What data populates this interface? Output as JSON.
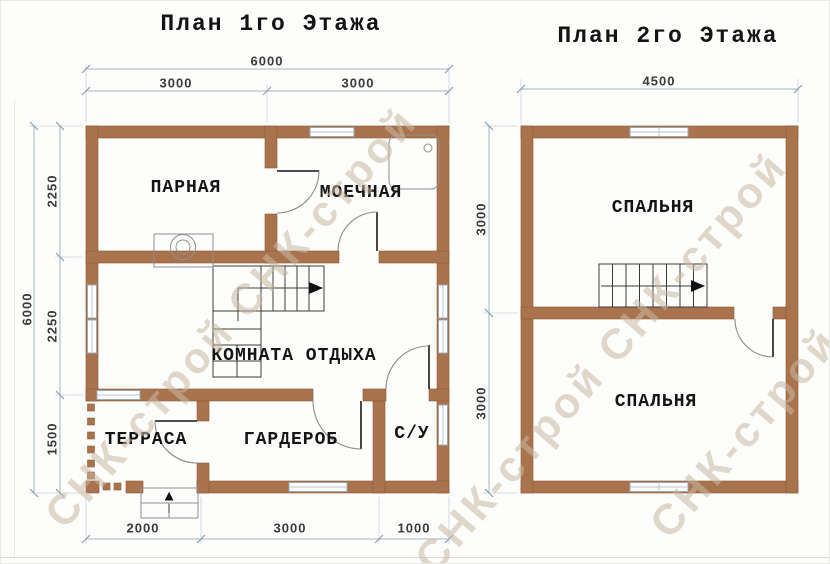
{
  "watermark": {
    "text": "СНК-строй",
    "stripes": [
      "СНК-строй СНК-строй",
      "СНК-строй СНК-строй",
      "СНК-строй"
    ],
    "color": "rgba(200,184,164,0.55)"
  },
  "floor1": {
    "title": "План 1го Этажа",
    "rooms": {
      "steam": "ПАРНАЯ",
      "wash": "МОЕЧНАЯ",
      "lounge": "КОМНАТА ОТДЫХА",
      "terrace": "ТЕРРАСА",
      "wardrobe": "ГАРДЕРОБ",
      "wc": "С/У"
    },
    "dims": {
      "top_total": "6000",
      "top_left": "3000",
      "top_right": "3000",
      "left_total": "6000",
      "left_top": "2250",
      "left_mid": "2250",
      "left_bottom": "1500",
      "bottom_left": "2000",
      "bottom_mid": "3000",
      "bottom_right": "1000"
    },
    "icons": {
      "entrance_arrow": "▲"
    }
  },
  "floor2": {
    "title": "План 2го Этажа",
    "rooms": {
      "bedroom_top": "СПАЛЬНЯ",
      "bedroom_bottom": "СПАЛЬНЯ"
    },
    "dims": {
      "top_total": "4500",
      "left_top": "3000",
      "left_bottom": "3000"
    }
  },
  "colors": {
    "wall": "#a9734d",
    "dim_line": "#a5b5c5",
    "drawing_line": "#3a3a3a"
  }
}
